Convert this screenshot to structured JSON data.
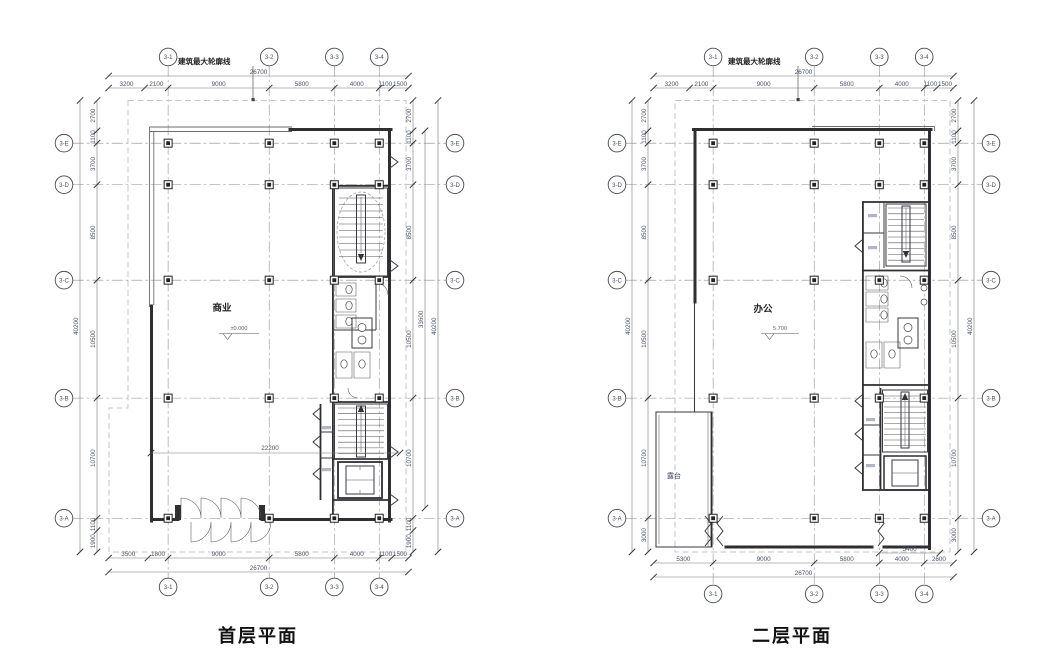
{
  "plans": [
    {
      "title": "首层平面",
      "outline_label": "建筑最大轮廓线",
      "room_label": "商业",
      "elevation": "±0.000",
      "interior_dim": "22200",
      "grid_cols": [
        "3-1",
        "3-2",
        "3-3",
        "3-4"
      ],
      "grid_rows": [
        "3-E",
        "3-D",
        "3-C",
        "3-B",
        "3-A"
      ],
      "dims": {
        "top_total": "26700",
        "top": [
          "3200",
          "2100",
          "9000",
          "5800",
          "4000",
          "1100",
          "1500"
        ],
        "bottom_total": "26700",
        "bottom": [
          "3500",
          "1800",
          "9000",
          "5800",
          "4000",
          "1100",
          "1500"
        ],
        "left_total": "40200",
        "left": [
          "2700",
          "1100",
          "3700",
          "8500",
          "10500",
          "10700",
          "1100",
          "1900"
        ],
        "right_total": "40200",
        "right_mid": "33600",
        "right": [
          "2700",
          "1100",
          "3700",
          "8500",
          "10500",
          "10700",
          "1100",
          "1900"
        ]
      }
    },
    {
      "title": "二层平面",
      "outline_label": "建筑最大轮廓线",
      "room_label": "办公",
      "elevation": "5.700",
      "terrace_label": "露台",
      "grid_cols": [
        "3-1",
        "3-2",
        "3-3",
        "3-4"
      ],
      "grid_rows": [
        "3-E",
        "3-D",
        "3-C",
        "3-B",
        "3-A"
      ],
      "dims": {
        "top_total": "26700",
        "top": [
          "3200",
          "2100",
          "9000",
          "5800",
          "4000",
          "1100",
          "1500"
        ],
        "bottom_total": "26700",
        "bottom": [
          "5300",
          "9000",
          "5800",
          "4000",
          "2600"
        ],
        "bottom_extra": "5400",
        "left_total": "40200",
        "left": [
          "2700",
          "1100",
          "3700",
          "8500",
          "10500",
          "10700",
          "3000"
        ],
        "right_total": "40200",
        "right": [
          "2700",
          "1100",
          "3700",
          "8500",
          "10500",
          "10700",
          "3000"
        ]
      }
    }
  ],
  "colors": {
    "wall": "#2e2e33",
    "dim_text": "#44506a",
    "grid": "#8a8a8a",
    "outline": "#c6c6c6"
  }
}
